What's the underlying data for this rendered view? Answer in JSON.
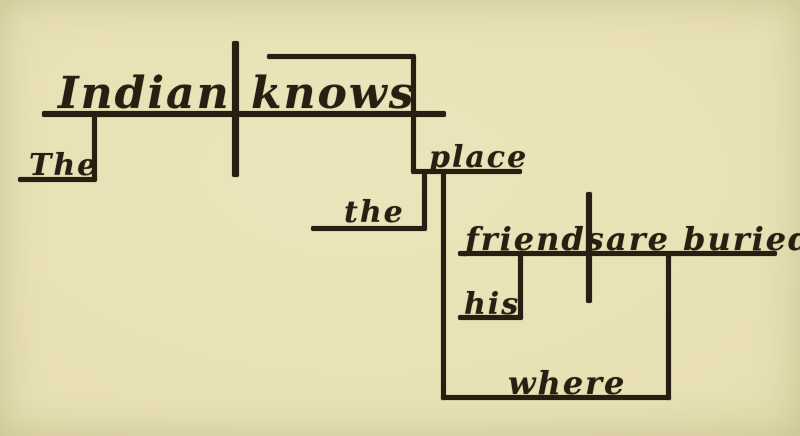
{
  "meta": {
    "diagram_type": "reed-kellogg-sentence-diagram",
    "sentence": "The Indian knows the place where his friends are buried."
  },
  "palette": {
    "paper": "#e7e0b2",
    "paper-light": "#ece5bc",
    "paper-dark": "#d9d2a2",
    "ink": "#261f12"
  },
  "words": {
    "subject": "Indian",
    "verb": "knows",
    "subject_article": "The",
    "object": "place",
    "object_article": "the",
    "clause_subject": "friends",
    "clause_verb": "are buried,",
    "clause_possessive": "his",
    "clause_connector": "where"
  }
}
